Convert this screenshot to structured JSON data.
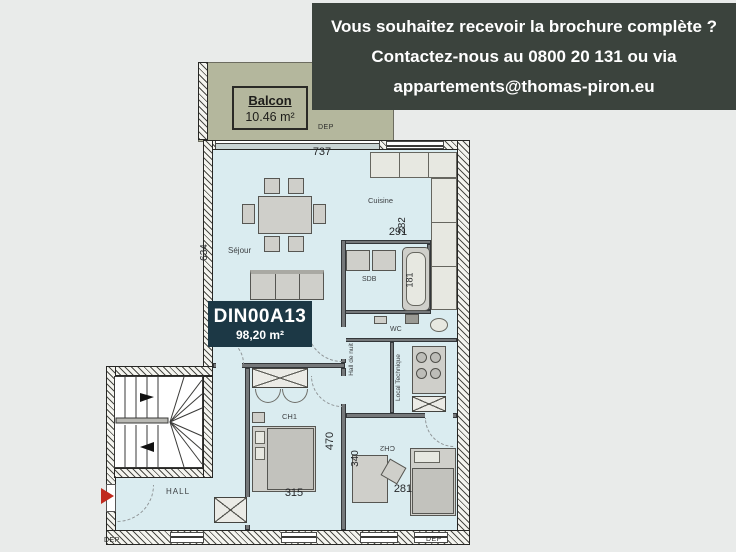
{
  "banner": {
    "line1": "Vous souhaitez recevoir la brochure complète ?",
    "line2": "Contactez-nous au 0800 20 131 ou via",
    "line3": "appartements@thomas-piron.eu"
  },
  "unit": {
    "code": "DIN00A13",
    "area": "98,20 m²"
  },
  "balcony": {
    "name": "Balcon",
    "area": "10.46 m²"
  },
  "rooms": {
    "sejour": "Séjour",
    "cuisine": "Cuisine",
    "sdb": "SDB",
    "wc": "WC",
    "hall_de_nuit": "Hall de nuit",
    "local_technique": "Local Technique",
    "ch1": "CH1",
    "ch2": "CH2",
    "hall": "HALL"
  },
  "dimensions": {
    "sejour_width": "737",
    "sejour_height": "634",
    "cuisine_height": "282",
    "cuisine_width": "291",
    "bath": "181",
    "ch1_height": "470",
    "ch1_width": "315",
    "ch2_height": "340",
    "ch2_width": "281"
  },
  "dep": {
    "balcony": "DEP",
    "bottom_left": "DEP",
    "bottom_right": "DEP"
  },
  "colors": {
    "banner_bg": "#3b433d",
    "unit_box_bg": "#1c3845",
    "room_fill": "#daecf0",
    "balcony_fill": "#b4b79d",
    "entrance_arrow": "#c02a1e"
  }
}
